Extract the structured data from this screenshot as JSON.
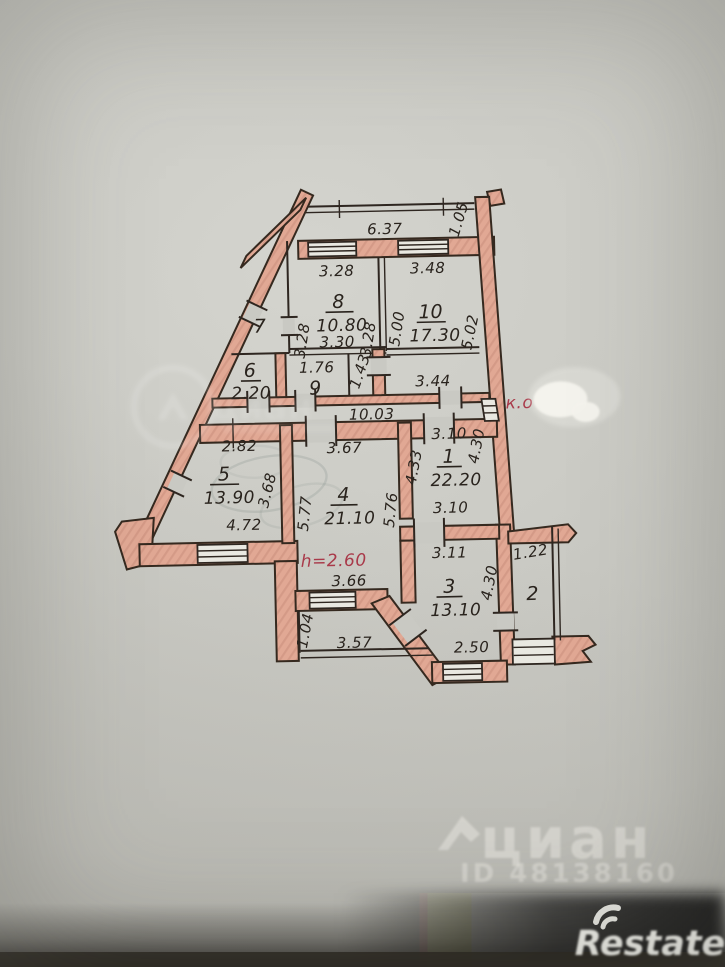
{
  "plan": {
    "rooms": [
      {
        "id": "8",
        "area": "10.80"
      },
      {
        "id": "10",
        "area": "17.30"
      },
      {
        "id": "7",
        "area": ""
      },
      {
        "id": "6",
        "area": "2.20"
      },
      {
        "id": "9",
        "area": ""
      },
      {
        "id": "5",
        "area": "13.90"
      },
      {
        "id": "4",
        "area": "21.10"
      },
      {
        "id": "1",
        "area": "22.20"
      },
      {
        "id": "3",
        "area": "13.10"
      },
      {
        "id": "2",
        "area": ""
      }
    ],
    "dims": [
      "6.37",
      "1.05",
      "3.28",
      "3.48",
      "3.28",
      "3.28",
      "5.00",
      "5.02",
      "3.30",
      "1.76",
      "1.43",
      "3.44",
      "10.03",
      "2.82",
      "3.67",
      "3.10",
      "4.30",
      "4.33",
      "3.68",
      "5.77",
      "5.76",
      "4.72",
      "3.10",
      "3.66",
      "3.11",
      "4.30",
      "2.50",
      "1.22",
      "3.57",
      "1.04"
    ],
    "annotations": {
      "ceiling_height": "h=2.60",
      "vent": "к.о"
    },
    "colors": {
      "wall_pink": "#dfa493",
      "ink": "#2e2620",
      "red_ink": "#a93a4a",
      "paper": "#c9c9c3"
    }
  },
  "watermarks": {
    "cian": {
      "word": "циан",
      "id": "ID 48138160"
    },
    "restate": {
      "word": "Restate"
    }
  }
}
